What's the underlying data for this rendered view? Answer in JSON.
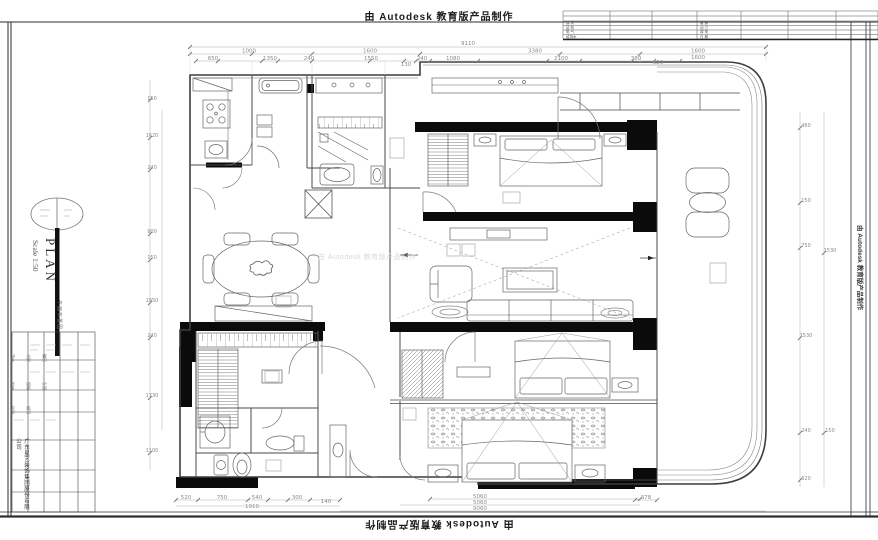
{
  "watermark": {
    "text": "由 Autodesk 教育版产品制作"
  },
  "plan_title": {
    "label": "PLAN",
    "scale": "Scale 1:50",
    "subtitle": "平面布置图"
  },
  "company": {
    "name": "广东星艺装饰集团股份有限公司"
  },
  "title_table": {
    "fields": [
      "审定",
      "审核",
      "校对",
      "设计",
      "制图",
      "比例",
      "日期",
      "图号"
    ]
  },
  "discipline_table": {
    "left": [
      "建 筑",
      "结 构",
      "电 气",
      "给排水"
    ],
    "right": [
      "暖 通",
      "动 力",
      "弱 电",
      "日 期"
    ]
  },
  "dimensions": {
    "top_total": "9110",
    "top_row2": [
      "1000",
      "1600",
      "3380",
      "1600",
      "1600"
    ],
    "top_row3": [
      "650",
      "1350",
      "240",
      "1550",
      "130",
      "240",
      "1080",
      "2100",
      "380",
      "620"
    ],
    "bottom_row": [
      "520",
      "750",
      "540",
      "300",
      "140"
    ],
    "bottom_sub": "1910",
    "bottom_right_stack": [
      "5060",
      "5060",
      "9060"
    ],
    "bottom_right_side": "378",
    "left_column": [
      "150",
      "1620",
      "240",
      "900",
      "150",
      "1950",
      "240",
      "1730",
      "1100"
    ],
    "right_column": [
      "480",
      "150",
      "750",
      "1530",
      "240",
      "620",
      "1530",
      "150"
    ]
  }
}
